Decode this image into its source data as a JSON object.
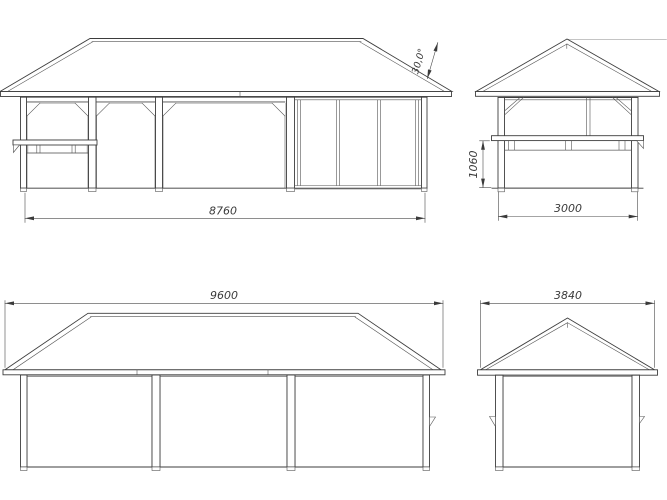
{
  "page": {
    "background": "#ffffff",
    "line_color": "#3d3d3d",
    "drawing_type": "gazebo elevation drawings"
  },
  "views": {
    "front_elevation": {
      "name": "front-elevation",
      "dims": {
        "wall_width": "8760",
        "roof_angle": "30,0°"
      }
    },
    "side_elevation": {
      "name": "side-elevation-with-counter",
      "dims": {
        "wall_width": "3000",
        "parapet_height": "1060"
      }
    },
    "rear_elevation": {
      "name": "rear-elevation",
      "dims": {
        "roof_width": "9600"
      }
    },
    "gable_end_elevation": {
      "name": "gable-end-elevation",
      "dims": {
        "roof_width": "3840"
      }
    }
  }
}
